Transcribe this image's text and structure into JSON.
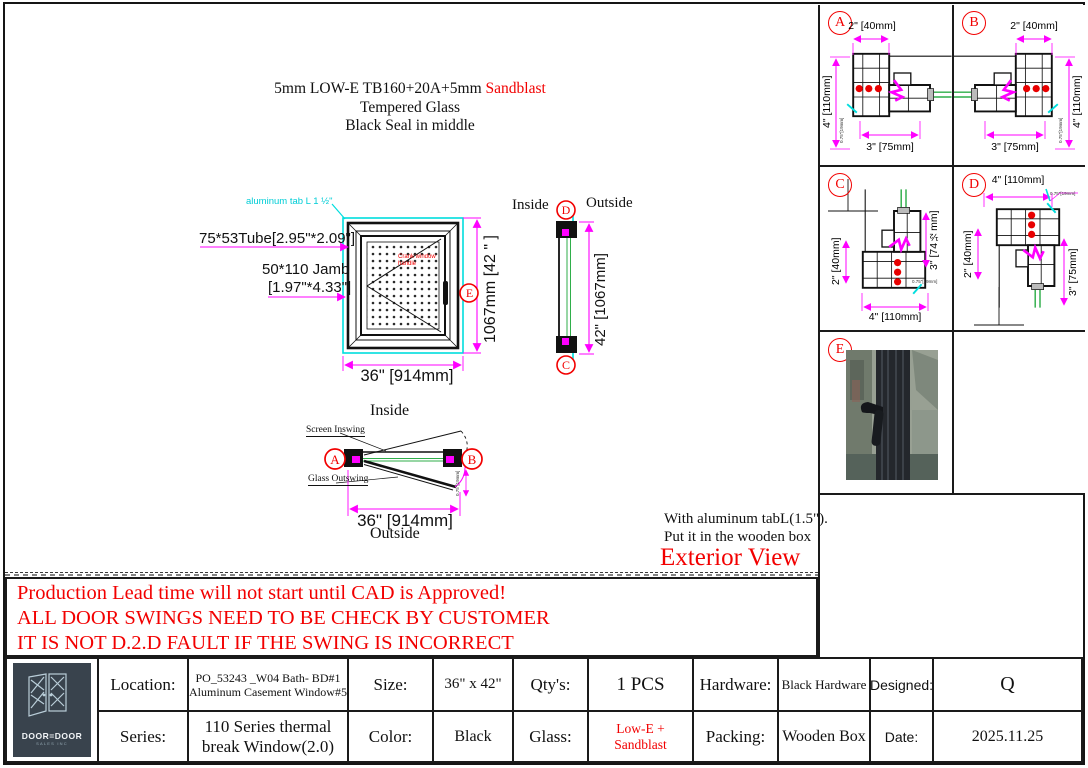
{
  "colors": {
    "dimension_line": "#ff00ff",
    "annotation_cyan": "#00dede",
    "alert_red": "#f20000",
    "glass_green": "#2fae4a",
    "logo_bg": "#39434d"
  },
  "glass_note": {
    "line1_black": "5mm LOW-E TB160+20A+5mm ",
    "line1_red": "Sandblast",
    "line2": "Tempered  Glass",
    "line3": "Black Seal in middle"
  },
  "front_view": {
    "tab_label": "aluminum tab L 1 ½\"",
    "tube_label": "75*53Tube[2.95\"*2.09\"]",
    "jamb_label1": "50*110 Jamb",
    "jamb_label2": "[1.97\"*4.33\"]",
    "handle_note1": "Crank window",
    "handle_note2": "handle",
    "height_dim": "1067mm [42 \" ]",
    "width_dim": "36\" [914mm]",
    "marker_e": "E"
  },
  "side_view": {
    "inside": "Inside",
    "outside": "Outside",
    "marker_d": "D",
    "marker_c": "C",
    "height_dim": "42\" [1067mm]"
  },
  "plan_view": {
    "inside": "Inside",
    "outside": "Outside",
    "marker_a": "A",
    "marker_b": "B",
    "screen_label": "Screen Inswing",
    "glass_label": "Glass Outswing",
    "width_dim": "36\" [914mm]",
    "tiny_note": "0.75\"[19mm]"
  },
  "exterior": {
    "note1": "With aluminum tabL(1.5\").",
    "note2": "Put it in the wooden box",
    "title": "Exterior View"
  },
  "warning": {
    "line1": "Production Lead time will not start until CAD is Approved!",
    "line2": "ALL DOOR SWINGS NEED TO BE CHECK BY CUSTOMER",
    "line3": "IT IS NOT D.2.D FAULT IF THE SWING IS  INCORRECT"
  },
  "details": {
    "a": {
      "marker": "A",
      "dim_top": "2\" [40mm]",
      "dim_side": "4\" [110mm]",
      "dim_bottom": "3\" [75mm]",
      "tiny": "0.75\"[19mm]"
    },
    "b": {
      "marker": "B",
      "dim_top": "2\" [40mm]",
      "dim_side": "4\" [110mm]",
      "dim_bottom": "3\" [75mm]",
      "tiny": "0.75\"[19mm]"
    },
    "c": {
      "marker": "C",
      "dim_left": "2\" [40mm]",
      "dim_right": "3\" [74½mm]",
      "dim_bottom": "4\" [110mm]",
      "tiny": "0.75\"[19mm]"
    },
    "d": {
      "marker": "D",
      "dim_top": "4\" [110mm]",
      "dim_left": "2\" [40mm]",
      "dim_right": "3\" [75mm]",
      "tiny": "0.75\"[19mm]"
    },
    "e": {
      "marker": "E"
    }
  },
  "logo": {
    "title": "DOOR=DOOR",
    "subtitle": "SALES INC"
  },
  "table": {
    "location_label": "Location:",
    "location_value": "PO_53243 _W04 Bath- BD#1\nAluminum Casement Window#5",
    "size_label": "Size:",
    "size_value": "36\" x 42\"",
    "qty_label": "Qty's:",
    "qty_value": "1 PCS",
    "hardware_label": "Hardware:",
    "hardware_value": "Black Hardware",
    "designed_label": "Designed:",
    "designed_value": "Q",
    "series_label": "Series:",
    "series_value": "110 Series thermal\nbreak Window(2.0)",
    "color_label": "Color:",
    "color_value": "Black",
    "glass_label": "Glass:",
    "glass_value": "Low-E + Sandblast",
    "packing_label": "Packing:",
    "packing_value": "Wooden Box",
    "date_label": "Date:",
    "date_value": "2025.11.25"
  }
}
